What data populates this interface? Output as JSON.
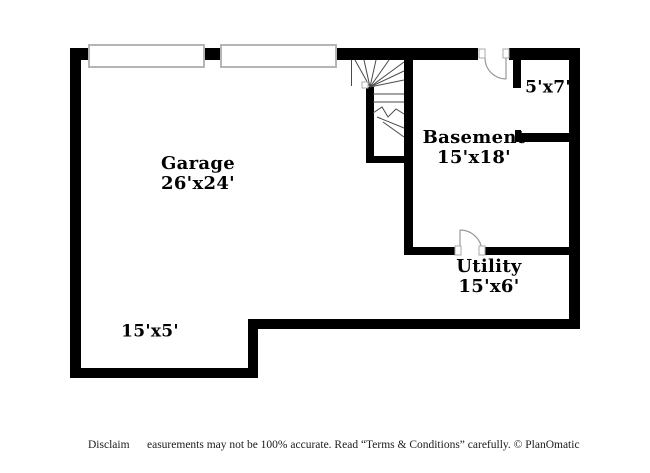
{
  "title": "Basement floor plan",
  "colors": {
    "wall": "#000000",
    "background": "#ffffff",
    "stair_line": "#4a4a4a",
    "door_line": "#999999",
    "label_text": "#000000"
  },
  "rooms": {
    "garage": {
      "name": "Garage",
      "dims": "26'x24'"
    },
    "basement": {
      "name": "Basement",
      "dims": "15'x18'"
    },
    "small_room": {
      "dims": "5'x7'"
    },
    "utility": {
      "name": "Utility",
      "dims": "15'x6'"
    },
    "alcove": {
      "dims": "15'x5'"
    }
  },
  "footer": {
    "disclaimer_prefix": "Disclaim",
    "disclaimer_body": "easurements may not be 100% accurate. Read “Terms & Conditions” carefully. © PlanOmatic"
  }
}
